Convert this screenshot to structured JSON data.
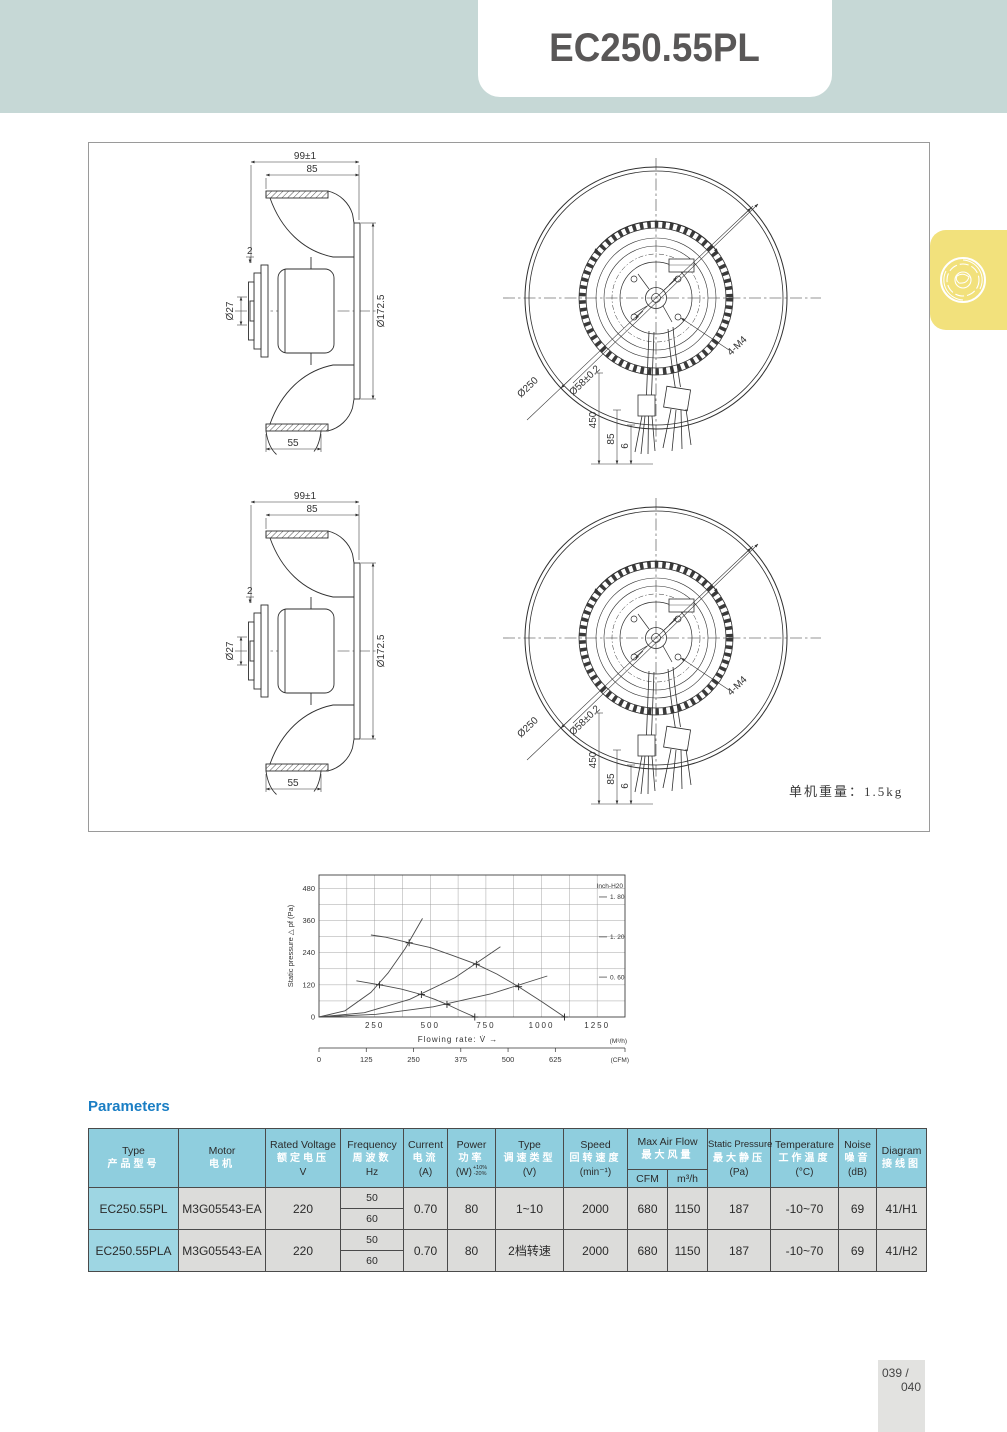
{
  "page": {
    "title": "EC250.55PL",
    "footer": {
      "line1": "039 /",
      "line2": "040"
    }
  },
  "colors": {
    "header_band": "#c6d8d6",
    "accent_blue": "#1a7ec4",
    "table_header_bg": "#8fcede",
    "table_row_bg": "#dcdcda",
    "badge_yellow": "#f2e17c",
    "title_text": "#595757"
  },
  "drawing": {
    "weight_note": "单机重量：1.5kg",
    "dims": {
      "overall_width": "99±1",
      "body_width": "85",
      "plate_offset": "2",
      "shaft_dia": "Ø27",
      "mount_dia": "Ø172.5",
      "inlet_depth": "55",
      "outer_dia": "Ø250",
      "bolt_circle_dia": "Ø58±0.2",
      "mount_holes": "4-M4",
      "wire_length": "450",
      "wire_dim_a": "85",
      "wire_dim_b": "6"
    }
  },
  "parameters": {
    "heading": "Parameters",
    "headers": {
      "type": {
        "en": "Type",
        "cn": "产品型号",
        "unit": ""
      },
      "motor": {
        "en": "Motor",
        "cn": "电机",
        "unit": ""
      },
      "voltage": {
        "en": "Rated  Voltage",
        "cn": "额定电压",
        "unit": "V"
      },
      "frequency": {
        "en": "Frequency",
        "cn": "周波数",
        "unit": "Hz"
      },
      "current": {
        "en": "Current",
        "cn": "电流",
        "unit": "(A)"
      },
      "power": {
        "en": "Power",
        "cn": "功率",
        "unit": "(W)",
        "tol_plus": "+10%",
        "tol_minus": "-20%"
      },
      "control": {
        "en": "Type",
        "cn": "调速类型",
        "unit": "(V)"
      },
      "speed": {
        "en": "Speed",
        "cn": "回转速度",
        "unit": "(min⁻¹)"
      },
      "airflow": {
        "en": "Max  Air  Flow",
        "cn": "最大风量",
        "sub1": "CFM",
        "sub2": "m³/h"
      },
      "pressure": {
        "en": "Static Pressure",
        "cn": "最大静压",
        "unit": "(Pa)"
      },
      "temperature": {
        "en": "Temperature",
        "cn": "工作温度",
        "unit": "(°C)"
      },
      "noise": {
        "en": "Noise",
        "cn": "噪音",
        "unit": "(dB)"
      },
      "diagram": {
        "en": "Diagram",
        "cn": "接线图",
        "unit": ""
      }
    },
    "rows": [
      {
        "type": "EC250.55PL",
        "motor": "M3G05543-EA",
        "voltage": "220",
        "freq_a": "50",
        "freq_b": "60",
        "current": "0.70",
        "power": "80",
        "control": "1~10",
        "speed": "2000",
        "cfm": "680",
        "m3h": "1150",
        "pressure": "187",
        "temperature": "-10~70",
        "noise": "69",
        "diagram": "41/H1"
      },
      {
        "type": "EC250.55PLA",
        "motor": "M3G05543-EA",
        "voltage": "220",
        "freq_a": "50",
        "freq_b": "60",
        "current": "0.70",
        "power": "80",
        "control": "2档转速",
        "speed": "2000",
        "cfm": "680",
        "m3h": "1150",
        "pressure": "187",
        "temperature": "-10~70",
        "noise": "69",
        "diagram": "41/H2"
      }
    ]
  },
  "chart_data": {
    "type": "line",
    "title": "",
    "xlabel": "Flowing rate: V̇  →",
    "x_unit": "(M³/h)",
    "ylabel": "Static pressure △  pf  (Pa)",
    "x_ticks": [
      250,
      500,
      750,
      1000,
      1250
    ],
    "y_ticks": [
      0,
      120,
      240,
      360,
      480
    ],
    "xlim": [
      0,
      1375
    ],
    "ylim": [
      0,
      530
    ],
    "grid": {
      "x_step": 125,
      "y_step": 60
    },
    "right_axis": {
      "title": "Inch-H20",
      "ticks": [
        {
          "label": "1. 80",
          "pa": 448
        },
        {
          "label": "1. 20",
          "pa": 299
        },
        {
          "label": "0. 60",
          "pa": 149
        }
      ]
    },
    "cfm_axis": {
      "unit_label": "(CFM)",
      "ticks": [
        0,
        125,
        250,
        375,
        500,
        625
      ],
      "cfm_to_m3h": 1.699
    },
    "series": [
      {
        "name": "fan-curve-high-speed",
        "points": [
          [
            233,
            306
          ],
          [
            300,
            298
          ],
          [
            405,
            277
          ],
          [
            500,
            259
          ],
          [
            600,
            230
          ],
          [
            707,
            197
          ],
          [
            800,
            160
          ],
          [
            897,
            113
          ],
          [
            1000,
            58
          ],
          [
            1103,
            0
          ]
        ],
        "markers": [
          [
            405,
            277
          ],
          [
            707,
            197
          ],
          [
            897,
            113
          ],
          [
            1103,
            0
          ]
        ]
      },
      {
        "name": "fan-curve-low-speed",
        "points": [
          [
            168,
            135
          ],
          [
            272,
            120
          ],
          [
            370,
            104
          ],
          [
            460,
            84
          ],
          [
            520,
            66
          ],
          [
            575,
            47
          ],
          [
            640,
            22
          ],
          [
            700,
            0
          ]
        ],
        "markers": [
          [
            272,
            120
          ],
          [
            460,
            84
          ],
          [
            575,
            47
          ],
          [
            700,
            0
          ]
        ]
      },
      {
        "name": "system-curve-1",
        "points": [
          [
            0,
            0
          ],
          [
            117,
            23
          ],
          [
            233,
            92
          ],
          [
            310,
            164
          ],
          [
            388,
            256
          ],
          [
            465,
            368
          ]
        ],
        "markers": []
      },
      {
        "name": "system-curve-2",
        "points": [
          [
            0,
            0
          ],
          [
            204,
            16
          ],
          [
            408,
            66
          ],
          [
            611,
            147
          ],
          [
            815,
            262
          ]
        ],
        "markers": []
      },
      {
        "name": "system-curve-3",
        "points": [
          [
            0,
            0
          ],
          [
            257,
            10
          ],
          [
            513,
            38
          ],
          [
            770,
            86
          ],
          [
            1026,
            153
          ]
        ],
        "markers": []
      }
    ]
  }
}
